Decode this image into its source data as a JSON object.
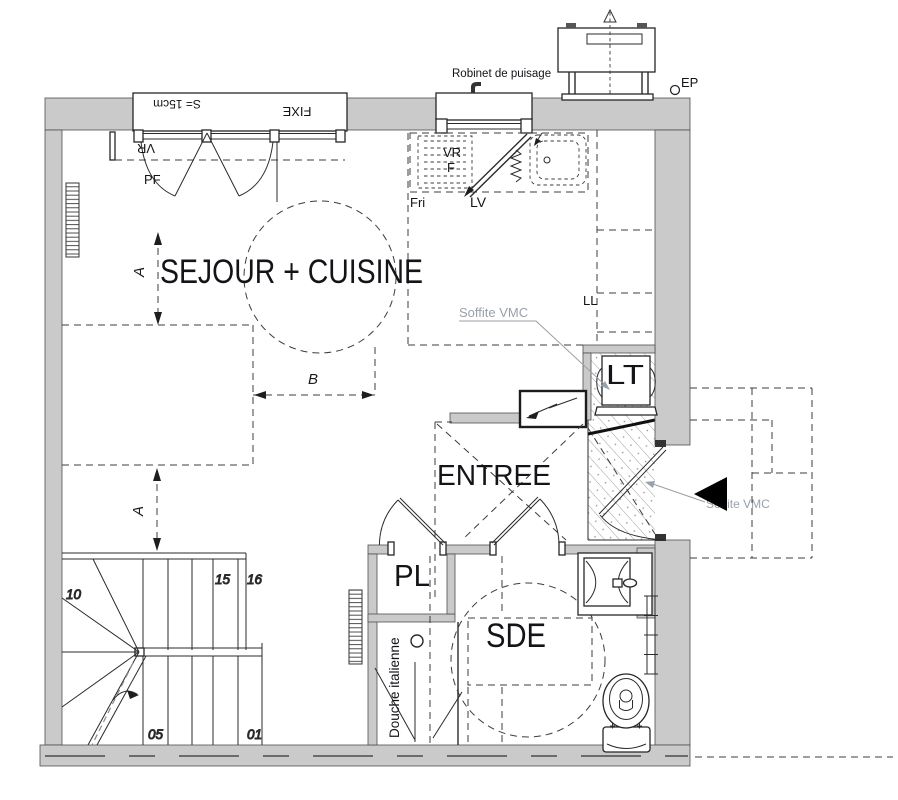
{
  "colors": {
    "wall_fill": "#cacaca",
    "line": "#2b2b2b",
    "muted_text": "#98a1a9",
    "hatch": "#9f9f9f",
    "background": "#ffffff"
  },
  "rooms": {
    "sejour_cuisine": "SEJOUR + CUISINE",
    "entree": "ENTREE",
    "pl": "PL",
    "sde": "SDE",
    "lt": "LT"
  },
  "labels": {
    "robinet_de_puisage": "Robinet de puisage",
    "ep": "EP",
    "window_sill": "S= 15cm",
    "fixe": "FIXE",
    "vr_window_left": "VR",
    "pf": "PF",
    "vr_kitchen": "VR",
    "f_kitchen": "F",
    "lv": "LV",
    "fri": "Fri",
    "ll": "LL",
    "soffite_vmc_kitchen": "Soffite VMC",
    "soffite_vmc_entry": "Soffite VMC",
    "douche_italienne": "Douche italienne"
  },
  "dimensions": {
    "a_upper": "A",
    "a_lower": "A",
    "b": "B"
  },
  "stair_numbers": {
    "n10": "10",
    "n15": "15",
    "n16": "16",
    "n05": "05",
    "n01": "01"
  }
}
